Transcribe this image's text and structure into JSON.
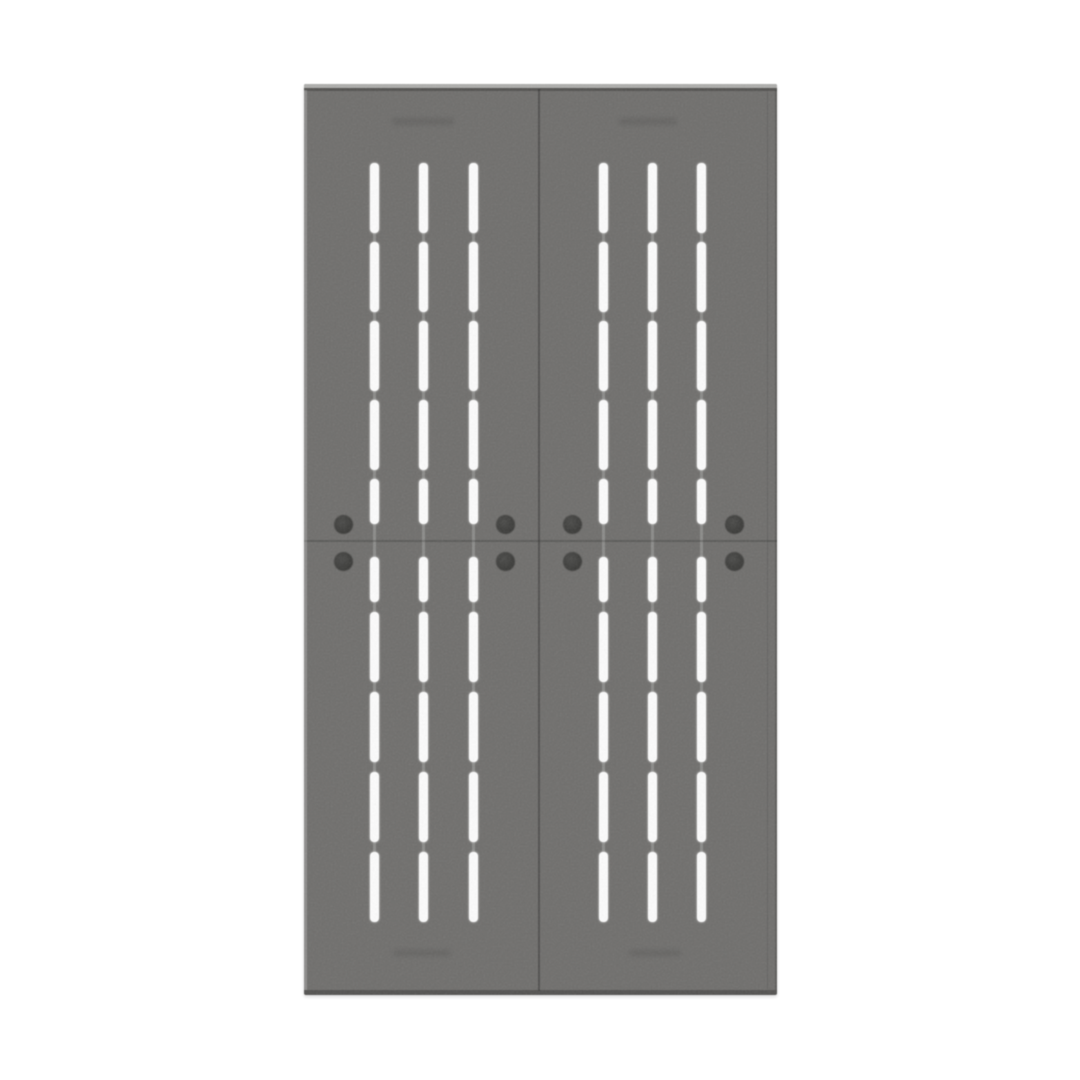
{
  "scene": {
    "type": "product-render",
    "description": "Front view of a gray steel double-door cabinet with louvered ventilation slots, round dark bolt knobs around the horizontal mid seam, and faint embossed marks near the top and bottom of each door",
    "background_color": "#ffffff"
  },
  "style": {
    "body_color": "#6f6e6c",
    "top_highlight_color": "#aeaeac",
    "edge_dark_color": "rgba(20,20,18,0.30)",
    "divider_color": "rgba(10,10,10,0.30)",
    "seam_color": "rgba(10,10,10,0.20)",
    "slot_color": "#fdfdfd",
    "groove_color": "rgba(255,255,255,0.20)",
    "knob_color_outer": "#363634",
    "knob_color_inner": "#4a4a48",
    "emboss_color": "rgba(0,0,0,0.09)"
  },
  "structure": {
    "door_count": 2,
    "columns_per_door": 3,
    "slots_per_column": 10,
    "knobs_per_door": 4,
    "embossed_marks": 4
  },
  "geometry": {
    "cabinet": {
      "left": 304,
      "top": 84,
      "width": 473,
      "height": 911
    },
    "divider_x": 234,
    "seam_y": 456,
    "slot_width": 9,
    "column_centers": [
      70,
      119,
      169,
      299,
      348,
      397
    ],
    "slot_rows": [
      {
        "y": 79,
        "h": 70
      },
      {
        "y": 158,
        "h": 70
      },
      {
        "y": 237,
        "h": 70
      },
      {
        "y": 316,
        "h": 70
      },
      {
        "y": 395,
        "h": 45
      },
      {
        "y": 473,
        "h": 45
      },
      {
        "y": 528,
        "h": 70
      },
      {
        "y": 608,
        "h": 70
      },
      {
        "y": 688,
        "h": 70
      },
      {
        "y": 768,
        "h": 70
      }
    ],
    "groove": {
      "top": 79,
      "bottom": 838
    },
    "knob_x_centers": [
      39,
      201,
      268,
      430
    ],
    "knob_y_centers": [
      440,
      477
    ],
    "knob_diameter": 19,
    "emboss_marks": [
      {
        "cx": 119,
        "cy": 37,
        "w": 62,
        "h": 7
      },
      {
        "cx": 344,
        "cy": 37,
        "w": 58,
        "h": 7
      },
      {
        "cx": 118,
        "cy": 869,
        "w": 58,
        "h": 6
      },
      {
        "cx": 351,
        "cy": 869,
        "w": 52,
        "h": 6
      }
    ]
  }
}
